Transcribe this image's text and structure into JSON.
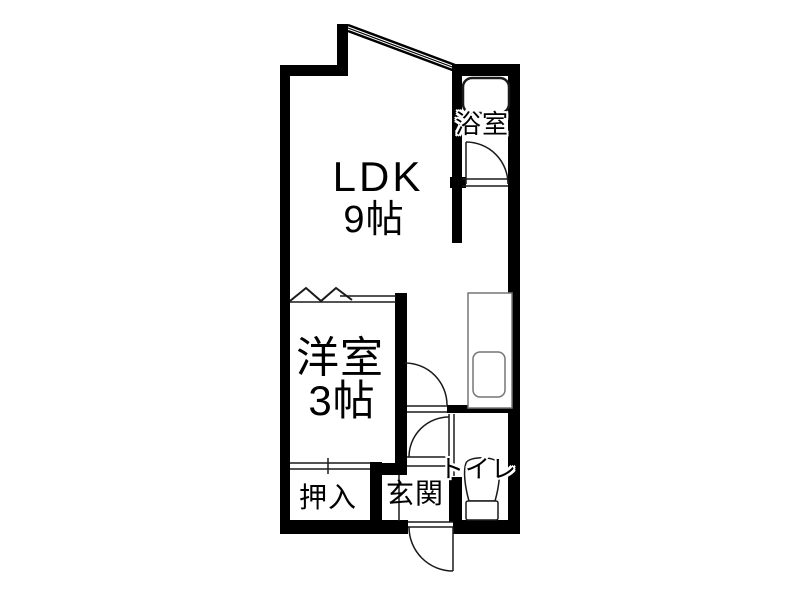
{
  "plan": {
    "title": "1LDK apartment floor plan",
    "rooms": {
      "ldk": {
        "name": "LDK",
        "size": "9帖"
      },
      "western": {
        "name": "洋室",
        "size": "3帖"
      },
      "bath": {
        "name": "浴室"
      },
      "toilet": {
        "name": "トイレ"
      },
      "closet": {
        "name": "押入"
      },
      "entry": {
        "name": "玄関"
      }
    },
    "colors": {
      "wall": "#000000",
      "background": "#ffffff",
      "line": "#1a1a1a",
      "fixture_line": "#777777"
    }
  }
}
